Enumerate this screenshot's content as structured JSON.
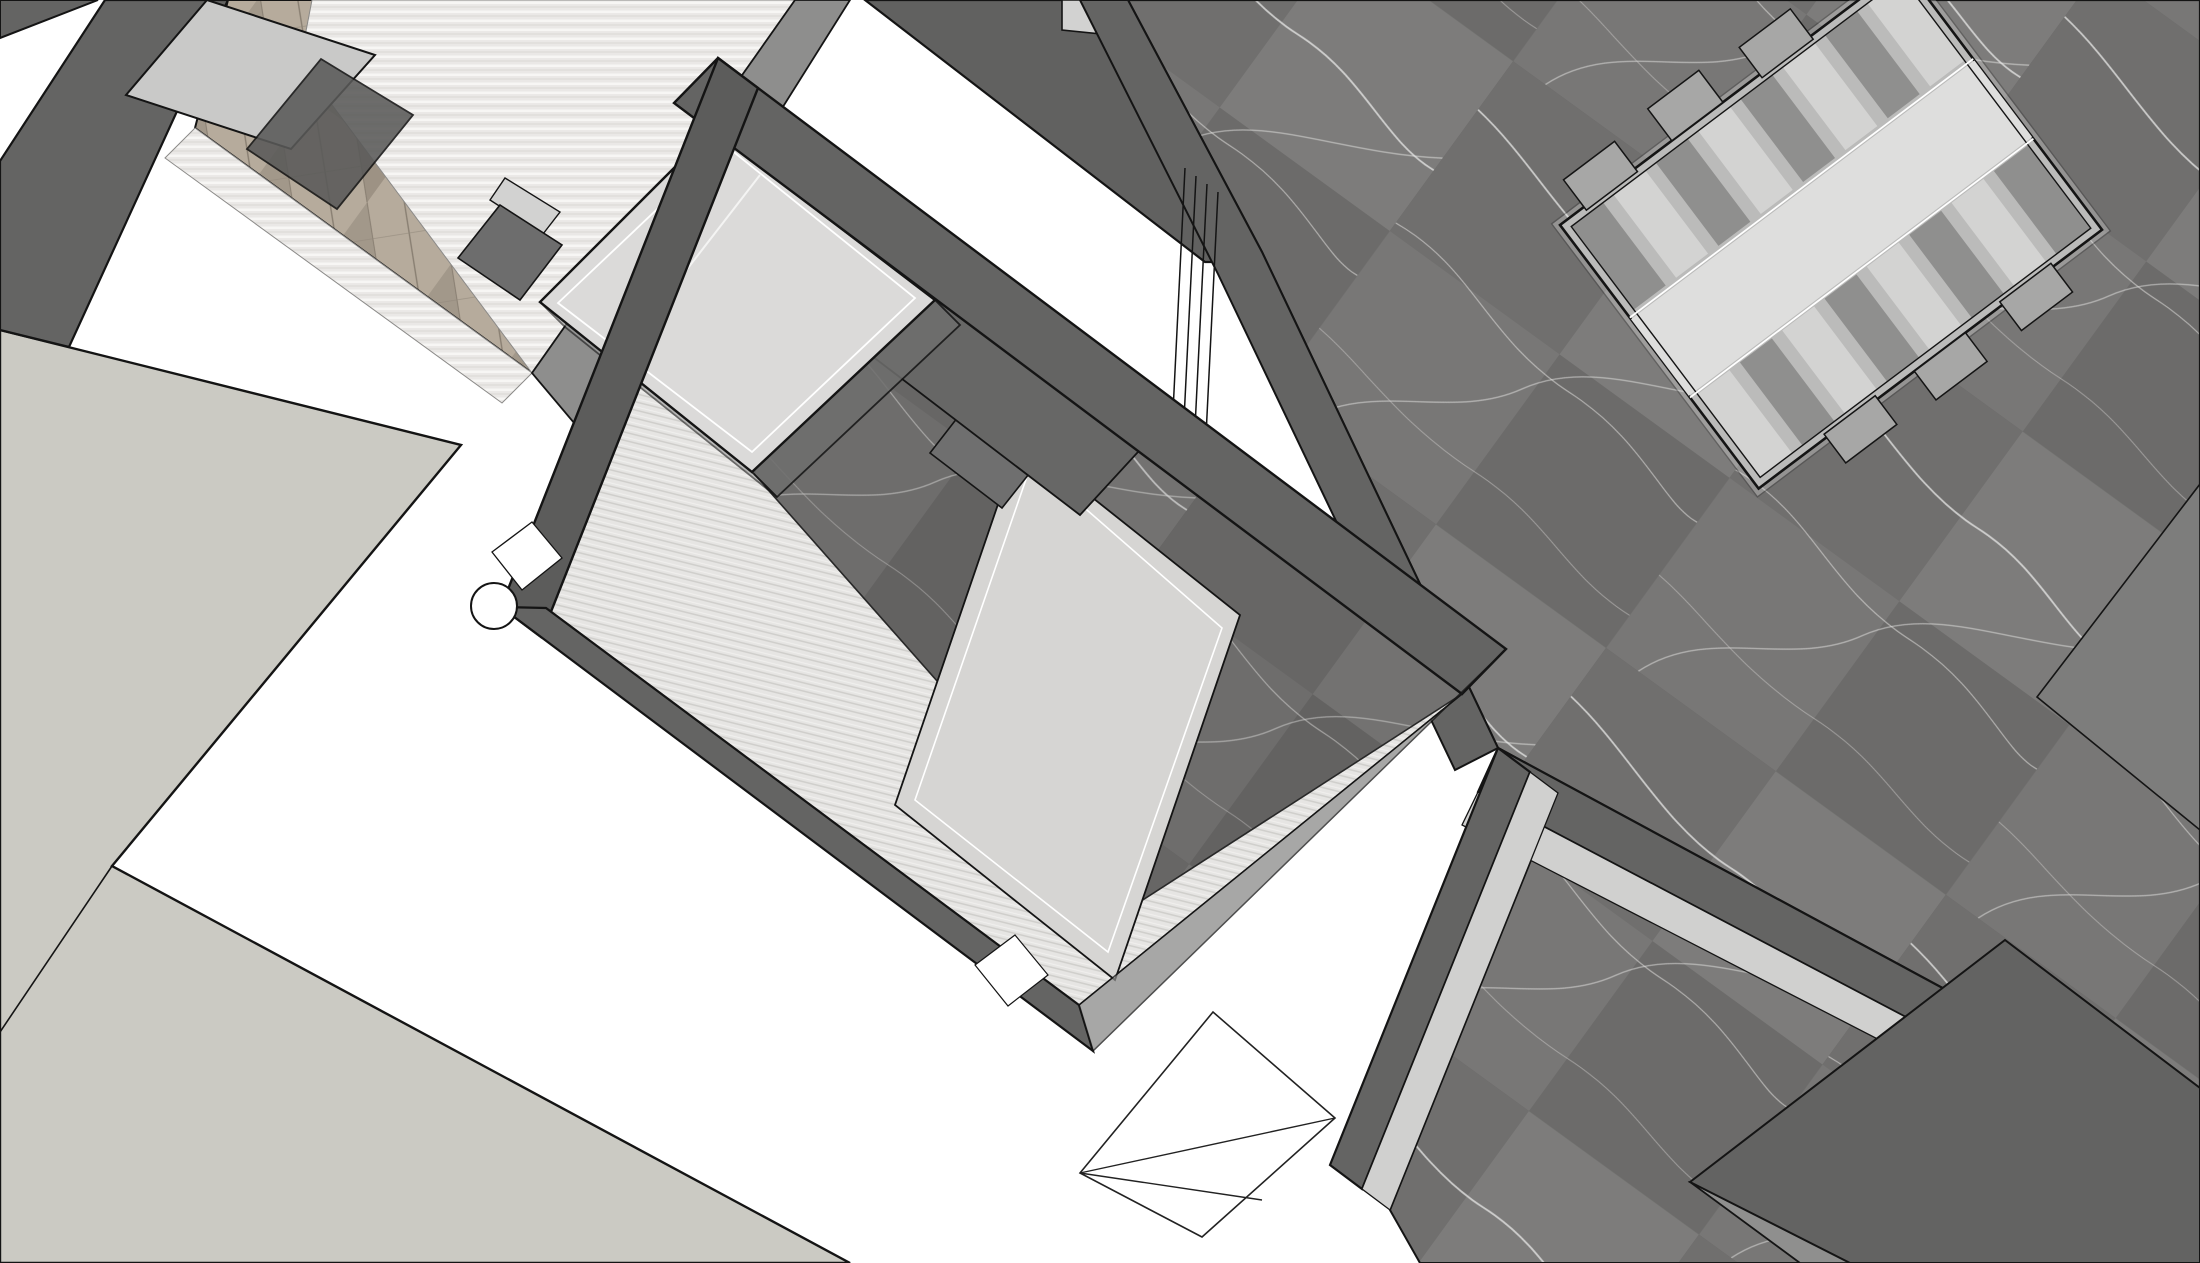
{
  "view": {
    "kind": "3d-architectural-model-viewport",
    "projection": "top-axonometric",
    "visible_text": "none"
  },
  "colors": {
    "background": "#ffffff",
    "outline": "#141414",
    "outline_soft": "#3a3a3a",
    "wall_dark": "#646463",
    "wall_darker": "#5c5c5b",
    "wall_mid": "#8e8e8d",
    "wall_inner_strip": "#d0d0cf",
    "terrace": "#cbcac3",
    "cabinet_top": "#c9c9c8",
    "glass_dark_panel": "#5a5a59",
    "block_dark": "#6d6d6d",
    "block_top": "#d2d2d1",
    "top_wedge": "#616160",
    "top_light_quad": "#d2d2d1",
    "shower_back_wall": "#676766",
    "cube_top": "#dbdad9",
    "cube_side_dark": "#6f6f6e",
    "cube_side_light": "#9b9b9a",
    "bench": "#d6d5d3",
    "bench_block": "#6f6f6f",
    "wall_se_glass": "#8a8a89",
    "flat_slab": "#7d7d7c",
    "closet_base": "#bbbbba",
    "closet_walkway": "#dededd",
    "closet_cell_dark": "#8f8f8e",
    "closet_cell_light": "#d3d3d2",
    "closet_tab": "#a7a7a6",
    "wedge_gray": "#8f8f8e",
    "wedge_dark": "#636362",
    "door_symbol_fill": "#ffffff",
    "circle_symbol_fill": "#ffffff",
    "marble_base": "#787776",
    "marble_vein": "#e8e8e6",
    "wood_base": "#ab9f91",
    "wood_light": "#b6ab9c",
    "wood_dark": "#9d9284",
    "stripe_base": "#eae8e6",
    "hatch_base": "#e6e5e3"
  },
  "scene": {
    "rooms": [
      {
        "name": "bedroom",
        "position": "top-left",
        "floor": "herringbone-parquet with glass floor panels",
        "objects": [
          "cabinet-top",
          "dark-glass-panel",
          "wardrobe-block"
        ]
      },
      {
        "name": "bathroom",
        "position": "center",
        "floor": "dark-marble + hatched shower tile",
        "objects": [
          "glass-shower-cube",
          "bench",
          "door-opening",
          "door-swing-symbol",
          "plumbing-circle-symbol",
          "glass-partition-lines"
        ]
      },
      {
        "name": "closet-room",
        "position": "top-right",
        "floor": "dark-marble",
        "objects": [
          "wardrobe-island-unit"
        ]
      },
      {
        "name": "lower-room",
        "position": "bottom-right",
        "floor": "dark-marble",
        "objects": [
          "dark-wedge-volume"
        ]
      },
      {
        "name": "terrace",
        "position": "bottom-left",
        "floor": "plain-light-gray",
        "objects": []
      }
    ],
    "wall_style": "white plan-cut bands with dark gray wall faces and black profile edges"
  }
}
